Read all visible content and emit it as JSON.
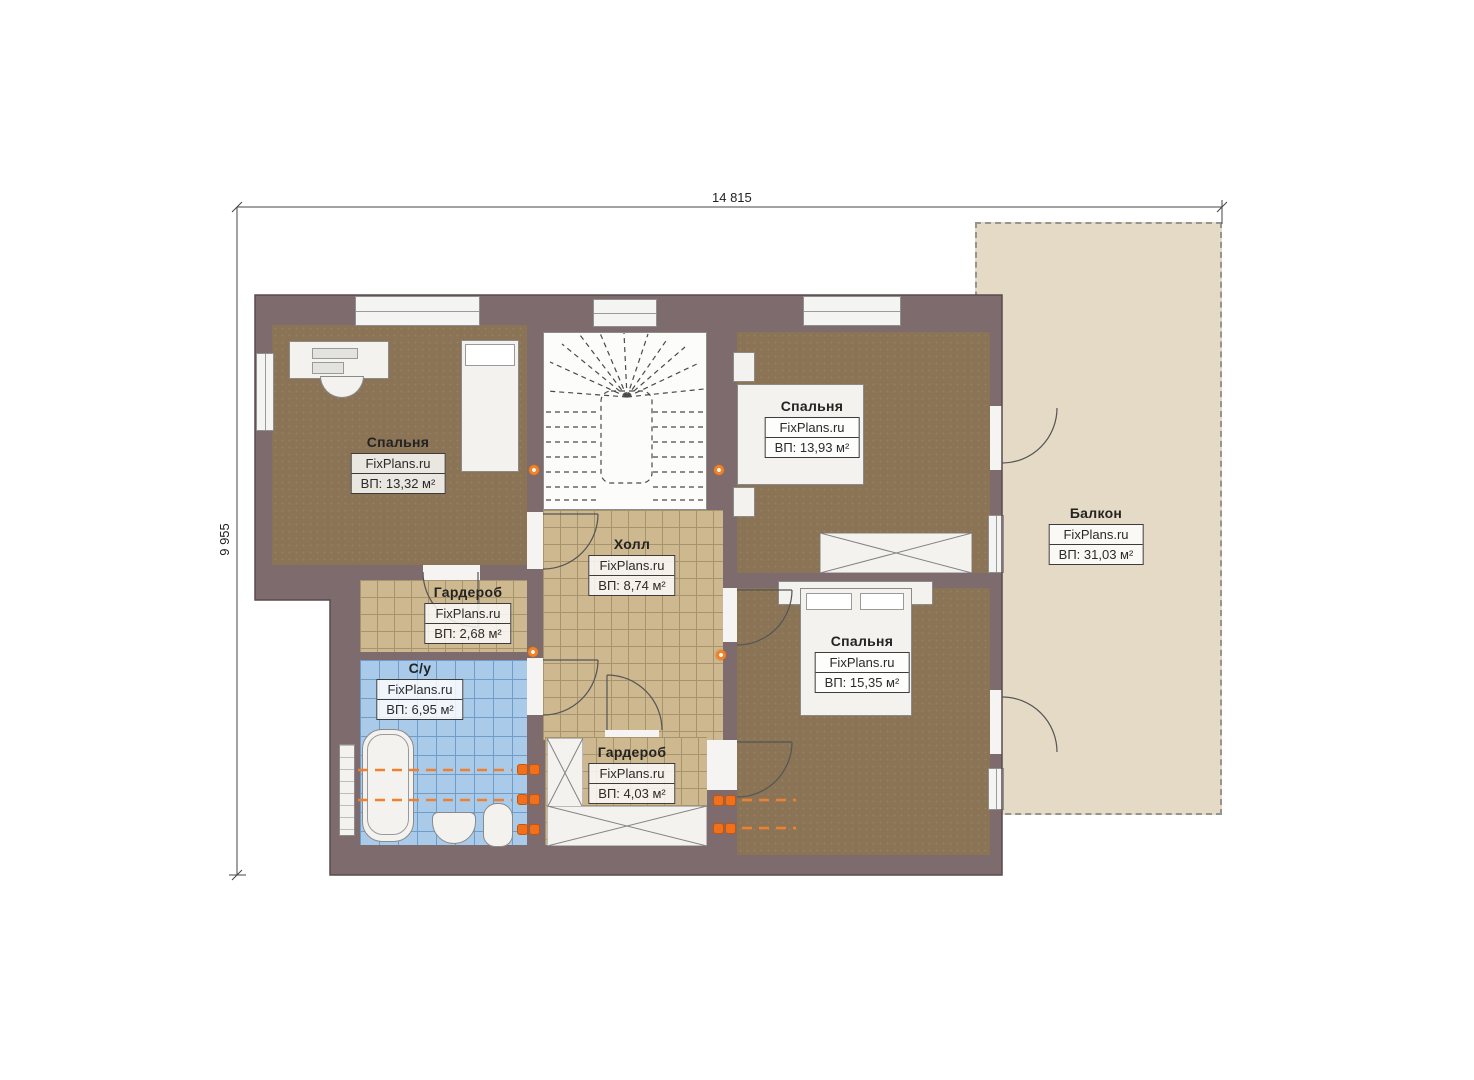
{
  "plan": {
    "dimensions": {
      "width": "14 815",
      "height": "9 955"
    },
    "watermark": "FixPlans.ru",
    "rooms": [
      {
        "id": "bedroom-top-left",
        "name": "Спальня",
        "watermark": "FixPlans.ru",
        "area": "ВП: 13,32 м²"
      },
      {
        "id": "bedroom-top",
        "name": "Спальня",
        "watermark": "FixPlans.ru",
        "area": "ВП: 13,93 м²"
      },
      {
        "id": "hall",
        "name": "Холл",
        "watermark": "FixPlans.ru",
        "area": "ВП: 8,74 м²"
      },
      {
        "id": "wardrobe-left",
        "name": "Гардероб",
        "watermark": "FixPlans.ru",
        "area": "ВП: 2,68 м²"
      },
      {
        "id": "bathroom",
        "name": "С/у",
        "watermark": "FixPlans.ru",
        "area": "ВП: 6,95 м²"
      },
      {
        "id": "bedroom-right",
        "name": "Спальня",
        "watermark": "FixPlans.ru",
        "area": "ВП: 15,35 м²"
      },
      {
        "id": "wardrobe-bottom",
        "name": "Гардероб",
        "watermark": "FixPlans.ru",
        "area": "ВП: 4,03 м²"
      },
      {
        "id": "balcony",
        "name": "Балкон",
        "watermark": "FixPlans.ru",
        "area": "ВП: 31,03 м²"
      }
    ],
    "colors": {
      "wall": "#7d6b6d",
      "carpet_floor": "#8b7456",
      "tile_floor": "#cdb88f",
      "bathroom_floor": "#a9cbe9",
      "balcony_floor": "#e4dac6",
      "fixture_white": "#f3f2ef",
      "accent_orange": "#ef701d"
    }
  }
}
